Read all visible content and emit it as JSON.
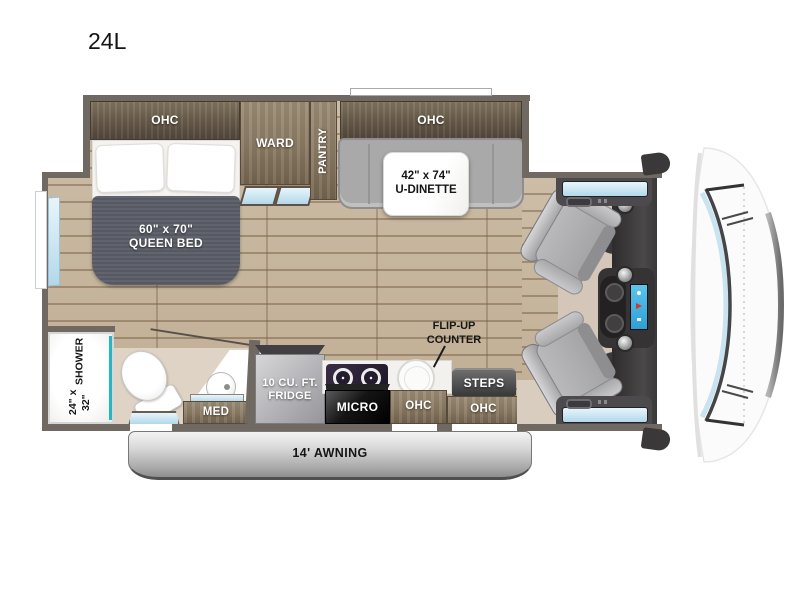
{
  "title": "24L",
  "plan": {
    "bedroom": {
      "ohc": "OHC",
      "ward": "WARD",
      "pantry": "PANTRY",
      "bed_size": "60\" x 70\"",
      "bed_name": "QUEEN BED"
    },
    "dinette": {
      "ohc": "OHC",
      "size": "42\" x 74\"",
      "name": "U-DINETTE"
    },
    "bath": {
      "shower_size": "24\" x 32\"",
      "shower_name": "SHOWER",
      "med": "MED"
    },
    "kitchen": {
      "fridge_size": "10 CU. FT.",
      "fridge_name": "FRIDGE",
      "micro": "MICRO",
      "ohc": "OHC"
    },
    "entry": {
      "steps": "STEPS",
      "ohc": "OHC",
      "flip_line1": "FLIP-UP",
      "flip_line2": "COUNTER"
    },
    "exterior": {
      "awning": "14' AWNING"
    }
  },
  "colors": {
    "wall": "#6f6962",
    "floor_wood": "#c9b8a2",
    "cabinet_dark": "#6b5e50",
    "cabinet_wood": "#8a7963",
    "accent_teal": "#25b6c3",
    "window_blue": "#cfe9f6",
    "blanket_gray": "#5a5d66",
    "dinette_gray": "#a9a9a9",
    "awning_silver": "#c7c7c7",
    "screen_blue": "#3fb2e4"
  }
}
